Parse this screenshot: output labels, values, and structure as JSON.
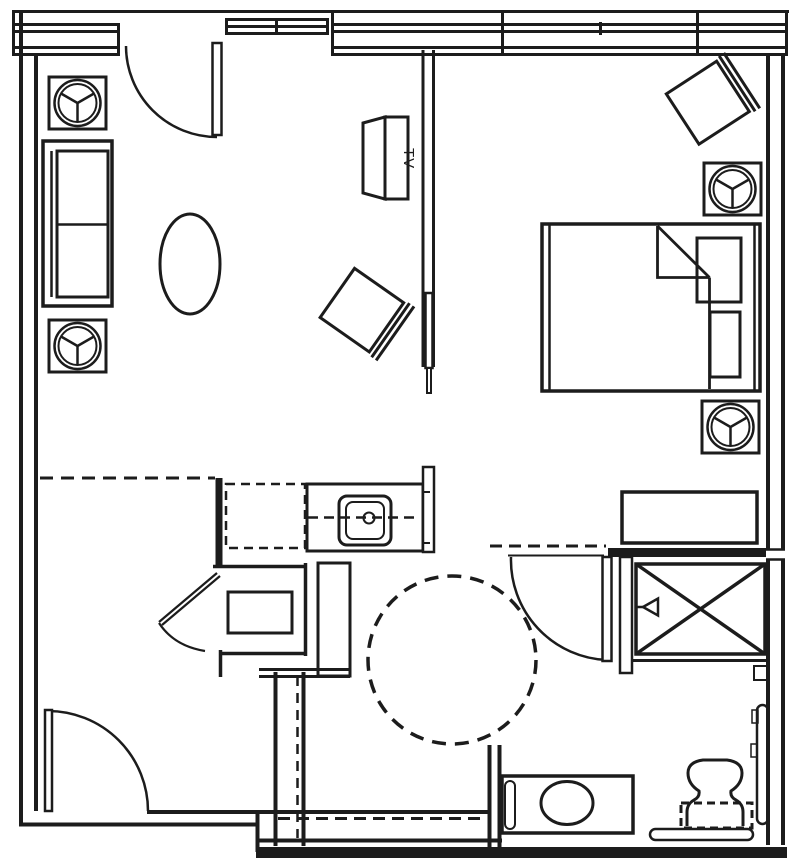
{
  "drawing": {
    "tv_label": "TV",
    "ink_color": "#1c1c1c",
    "background_color": "#ffffff"
  },
  "symbols": {
    "doors": [
      "entry-door-swing",
      "bottom-left-door-swing",
      "bathroom-door-swing",
      "vanity-alcove-door-swing",
      "sliding-door-leaf"
    ],
    "fixtures": [
      "kitchen-sink",
      "lavatory-basin",
      "toilet",
      "grab-bar-horizontal",
      "grab-bar-vertical",
      "wheelchair-turning-circle"
    ],
    "furniture": [
      "sofa",
      "oval-coffee-table",
      "round-lamp-table",
      "tilted-chair",
      "tv-cabinet",
      "bed",
      "pillow",
      "dresser",
      "closet-x",
      "undercounter-appliance"
    ]
  }
}
